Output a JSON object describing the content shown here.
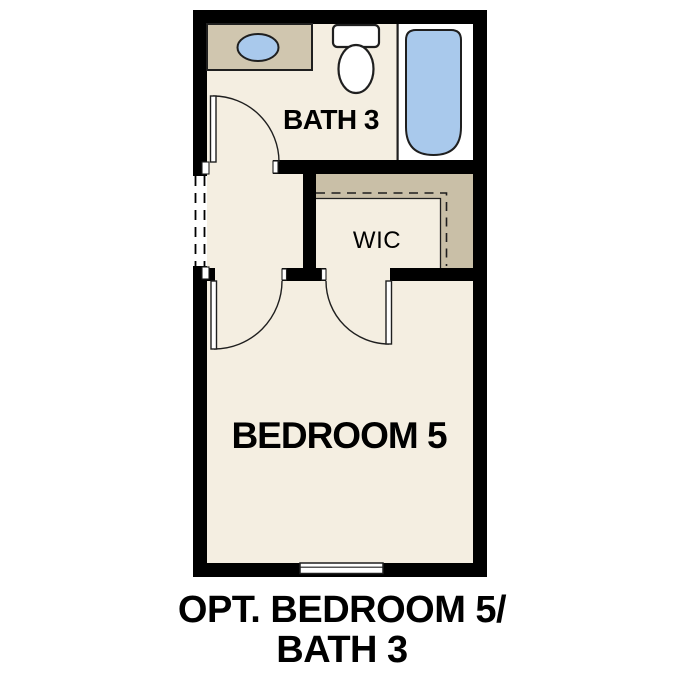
{
  "rooms": {
    "bath": {
      "label": "BATH 3"
    },
    "wic": {
      "label": "WIC"
    },
    "bedroom": {
      "label": "BEDROOM 5"
    }
  },
  "caption": {
    "line1": "OPT. BEDROOM 5/",
    "line2": "BATH 3"
  },
  "fixtures": [
    "vanity-counter",
    "sink-basin",
    "toilet",
    "bathtub",
    "window"
  ],
  "colors": {
    "wall": "#000000",
    "floor": "#f4eee1",
    "counter": "#d0c6af",
    "closet_shelf": "#c9bfa7",
    "fixture_blue": "#a9c9ec",
    "outline": "#1f1f1f",
    "text": "#000000",
    "background": "#ffffff"
  }
}
